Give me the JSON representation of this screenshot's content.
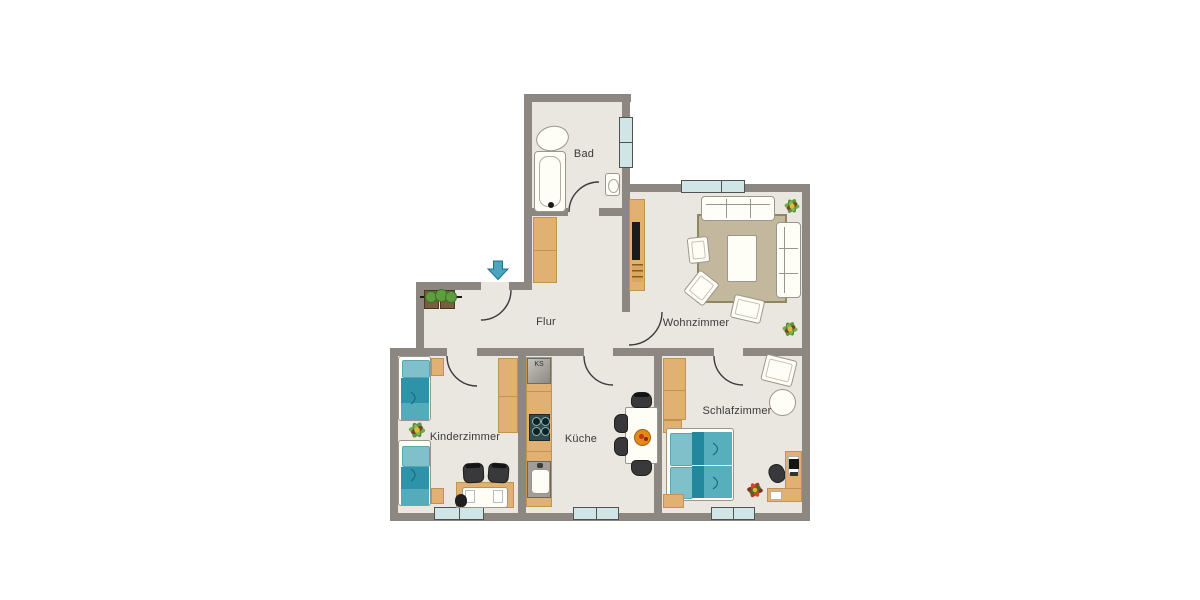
{
  "rooms": {
    "bad": {
      "label": "Bad"
    },
    "flur": {
      "label": "Flur"
    },
    "wohnzimmer": {
      "label": "Wohnzimmer"
    },
    "kinderzimmer": {
      "label": "Kinderzimmer"
    },
    "kueche": {
      "label": "Küche"
    },
    "schlafzimmer": {
      "label": "Schlafzimmer"
    }
  },
  "labels": {
    "fridge": "KS"
  },
  "colors": {
    "wall": "#8c8781",
    "floor": "#eae7e1",
    "wood": "#e0b173",
    "wood_dark": "#c3924f",
    "window": "#cfe5e6",
    "window_border": "#4f5354",
    "teal_dark": "#2e93a8",
    "teal_mid": "#54abba",
    "teal_light": "#7fc0cb",
    "rug": "#c3b79e",
    "rug_border": "#8d8763",
    "white_f": "#fffef6",
    "line": "#9b968c",
    "chair_dark": "#39393b",
    "label": "#3a3a3a",
    "accent_arrow": "#4aa6bf"
  }
}
